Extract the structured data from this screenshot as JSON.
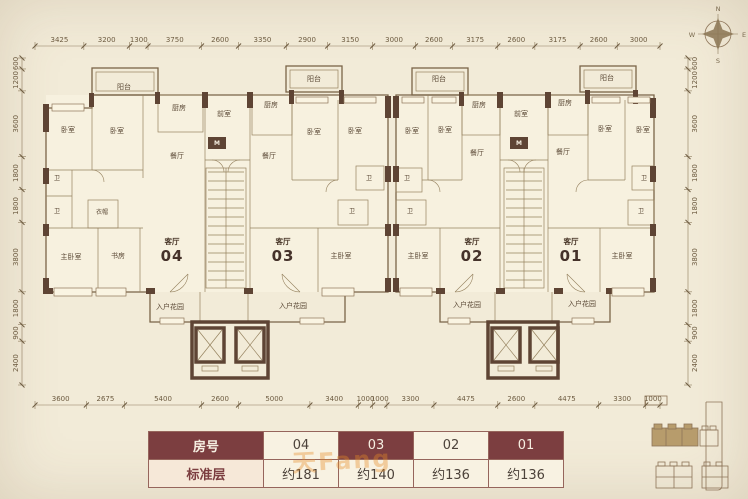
{
  "compass": {
    "n": "N",
    "e": "E",
    "s": "S",
    "w": "W"
  },
  "dimensions": {
    "top": [
      "3425",
      "3200",
      "1300",
      "3750",
      "2600",
      "3350",
      "2900",
      "3150",
      "3000",
      "2600",
      "3175",
      "2600",
      "3175",
      "2600",
      "3000"
    ],
    "bottom": [
      "3600",
      "2675",
      "5400",
      "2600",
      "5000",
      "3400",
      "1000",
      "1000",
      "3300",
      "4475",
      "2600",
      "4475",
      "3300",
      "1000"
    ],
    "left": [
      "600",
      "1200",
      "3600",
      "1800",
      "1800",
      "3800",
      "1800",
      "900",
      "2400"
    ],
    "right": [
      "600",
      "1200",
      "3600",
      "1800",
      "1800",
      "3800",
      "1800",
      "900",
      "2400"
    ]
  },
  "plan": {
    "rooms": [
      {
        "t": "阳台",
        "x": 124,
        "y": 89
      },
      {
        "t": "厨房",
        "x": 179,
        "y": 110
      },
      {
        "t": "卧室",
        "x": 68,
        "y": 132
      },
      {
        "t": "卧室",
        "x": 117,
        "y": 133
      },
      {
        "t": "餐厅",
        "x": 177,
        "y": 158
      },
      {
        "t": "卫",
        "x": 57,
        "y": 180,
        "cls": "s"
      },
      {
        "t": "卫",
        "x": 57,
        "y": 213,
        "cls": "s"
      },
      {
        "t": "衣帽",
        "x": 102,
        "y": 214,
        "cls": "s"
      },
      {
        "t": "主卧室",
        "x": 71,
        "y": 259
      },
      {
        "t": "书房",
        "x": 118,
        "y": 258
      },
      {
        "t": "入户花园",
        "x": 170,
        "y": 309
      },
      {
        "t": "前室",
        "x": 224,
        "y": 116
      },
      {
        "t": "M",
        "x": 217,
        "y": 145,
        "cls": "m"
      },
      {
        "t": "厨房",
        "x": 271,
        "y": 107
      },
      {
        "t": "阳台",
        "x": 314,
        "y": 81
      },
      {
        "t": "卧室",
        "x": 314,
        "y": 134
      },
      {
        "t": "卧室",
        "x": 355,
        "y": 133
      },
      {
        "t": "餐厅",
        "x": 269,
        "y": 158
      },
      {
        "t": "卫",
        "x": 369,
        "y": 180,
        "cls": "s"
      },
      {
        "t": "卫",
        "x": 352,
        "y": 213,
        "cls": "s"
      },
      {
        "t": "主卧室",
        "x": 341,
        "y": 258
      },
      {
        "t": "入户花园",
        "x": 293,
        "y": 308
      },
      {
        "t": "卫",
        "x": 407,
        "y": 180,
        "cls": "s"
      },
      {
        "t": "卫",
        "x": 410,
        "y": 213,
        "cls": "s"
      },
      {
        "t": "卧室",
        "x": 412,
        "y": 133
      },
      {
        "t": "卧室",
        "x": 445,
        "y": 132
      },
      {
        "t": "阳台",
        "x": 439,
        "y": 81
      },
      {
        "t": "厨房",
        "x": 479,
        "y": 107
      },
      {
        "t": "餐厅",
        "x": 477,
        "y": 155
      },
      {
        "t": "主卧室",
        "x": 418,
        "y": 258
      },
      {
        "t": "入户花园",
        "x": 467,
        "y": 307
      },
      {
        "t": "前室",
        "x": 521,
        "y": 116
      },
      {
        "t": "M",
        "x": 519,
        "y": 145,
        "cls": "m"
      },
      {
        "t": "厨房",
        "x": 565,
        "y": 105
      },
      {
        "t": "阳台",
        "x": 607,
        "y": 80
      },
      {
        "t": "卧室",
        "x": 605,
        "y": 131
      },
      {
        "t": "卧室",
        "x": 643,
        "y": 132
      },
      {
        "t": "餐厅",
        "x": 563,
        "y": 154
      },
      {
        "t": "卫",
        "x": 644,
        "y": 180,
        "cls": "s"
      },
      {
        "t": "卫",
        "x": 641,
        "y": 213,
        "cls": "s"
      },
      {
        "t": "主卧室",
        "x": 622,
        "y": 258
      },
      {
        "t": "入户花园",
        "x": 582,
        "y": 306
      }
    ],
    "units": [
      {
        "room": "客厅",
        "no": "04",
        "x": 172,
        "y": 244
      },
      {
        "room": "客厅",
        "no": "03",
        "x": 283,
        "y": 244
      },
      {
        "room": "客厅",
        "no": "02",
        "x": 472,
        "y": 244
      },
      {
        "room": "客厅",
        "no": "01",
        "x": 571,
        "y": 244
      }
    ]
  },
  "table": {
    "rows": [
      {
        "header": "房号",
        "cells": [
          "04",
          "03",
          "02",
          "01"
        ]
      },
      {
        "header": "标准层",
        "cells": [
          "约181",
          "约140",
          "约136",
          "约136"
        ]
      }
    ]
  },
  "watermark": "天Fang"
}
